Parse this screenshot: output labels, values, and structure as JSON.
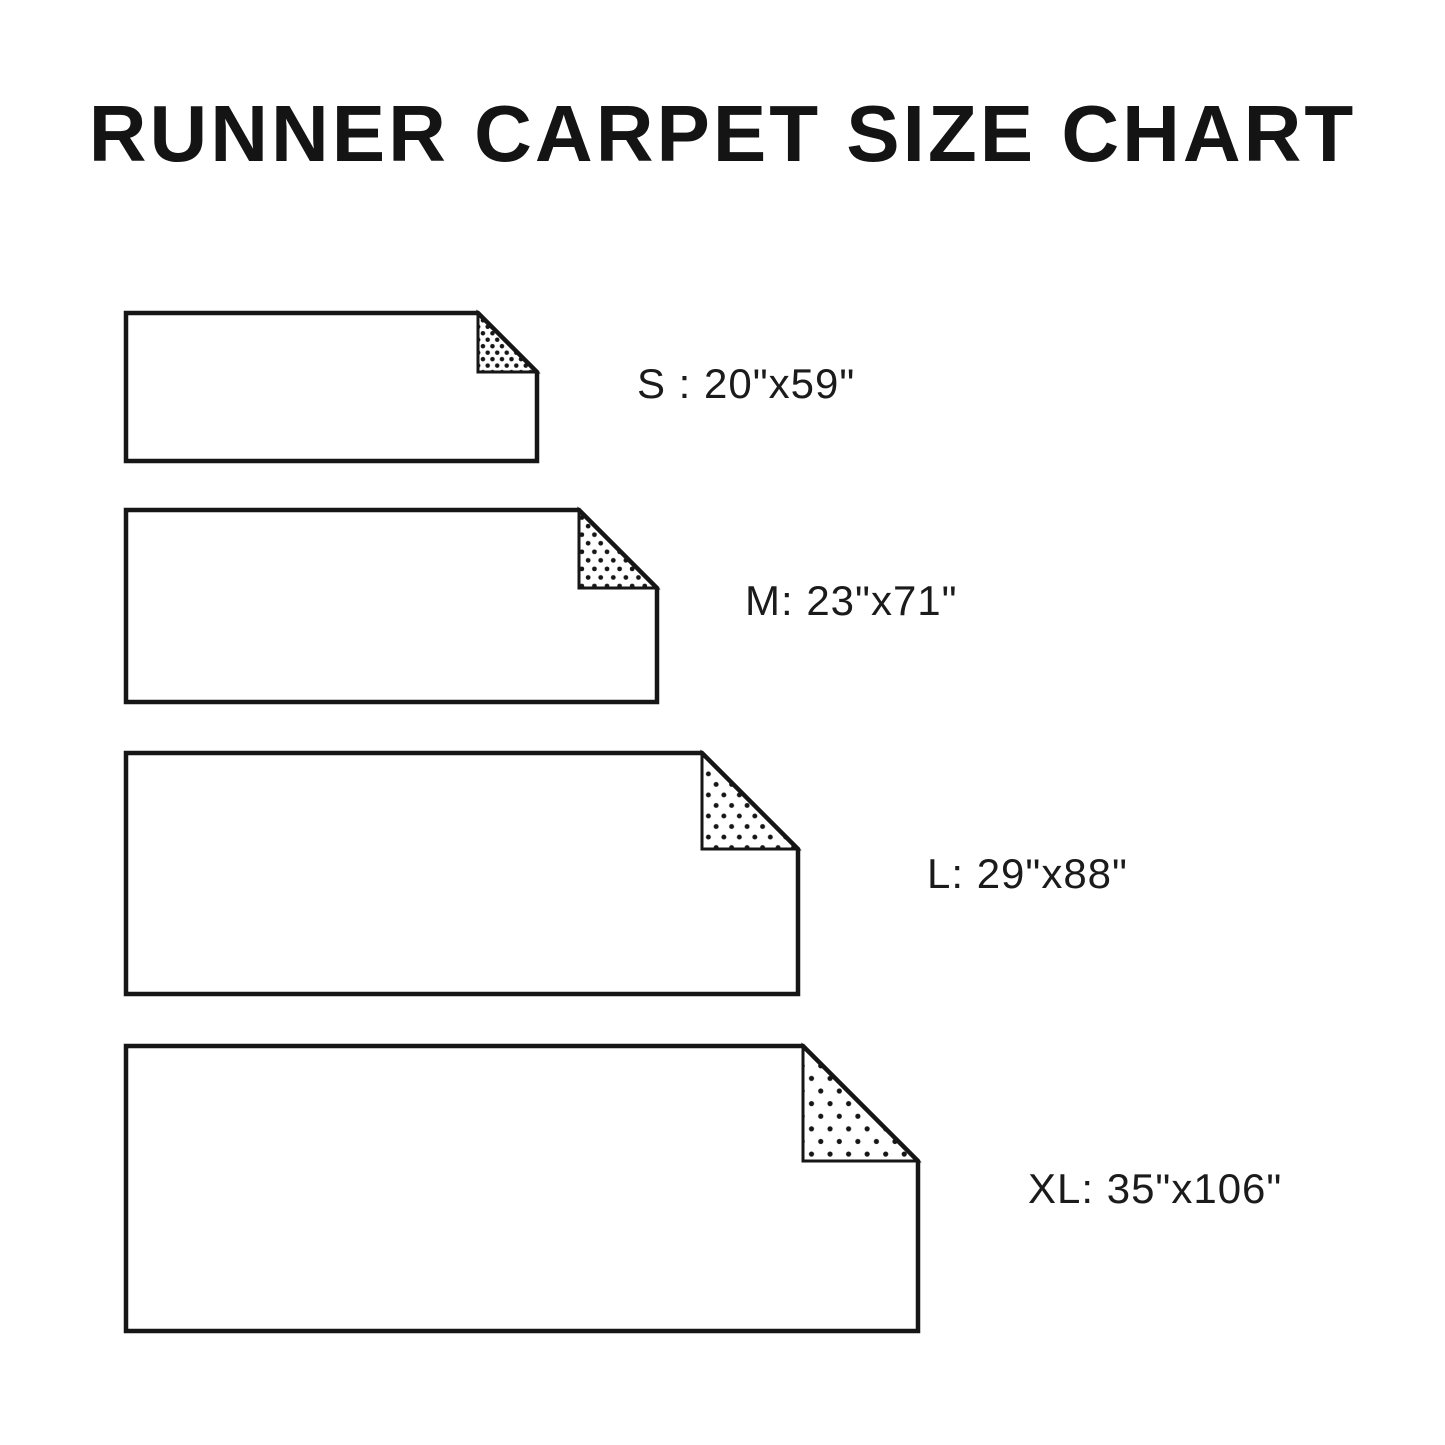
{
  "title": "RUNNER CARPET SIZE CHART",
  "sizes": [
    {
      "code": "S",
      "label": "S : 20\"x59\"",
      "width_in": "20\"",
      "length_in": "59\""
    },
    {
      "code": "M",
      "label": "M: 23\"x71\"",
      "width_in": "23\"",
      "length_in": "71\""
    },
    {
      "code": "L",
      "label": "L: 29\"x88\"",
      "width_in": "29\"",
      "length_in": "88\""
    },
    {
      "code": "XL",
      "label": "XL: 35\"x106\"",
      "width_in": "35\"",
      "length_in": "106\""
    }
  ],
  "colors": {
    "ink": "#161616",
    "background": "#ffffff"
  }
}
